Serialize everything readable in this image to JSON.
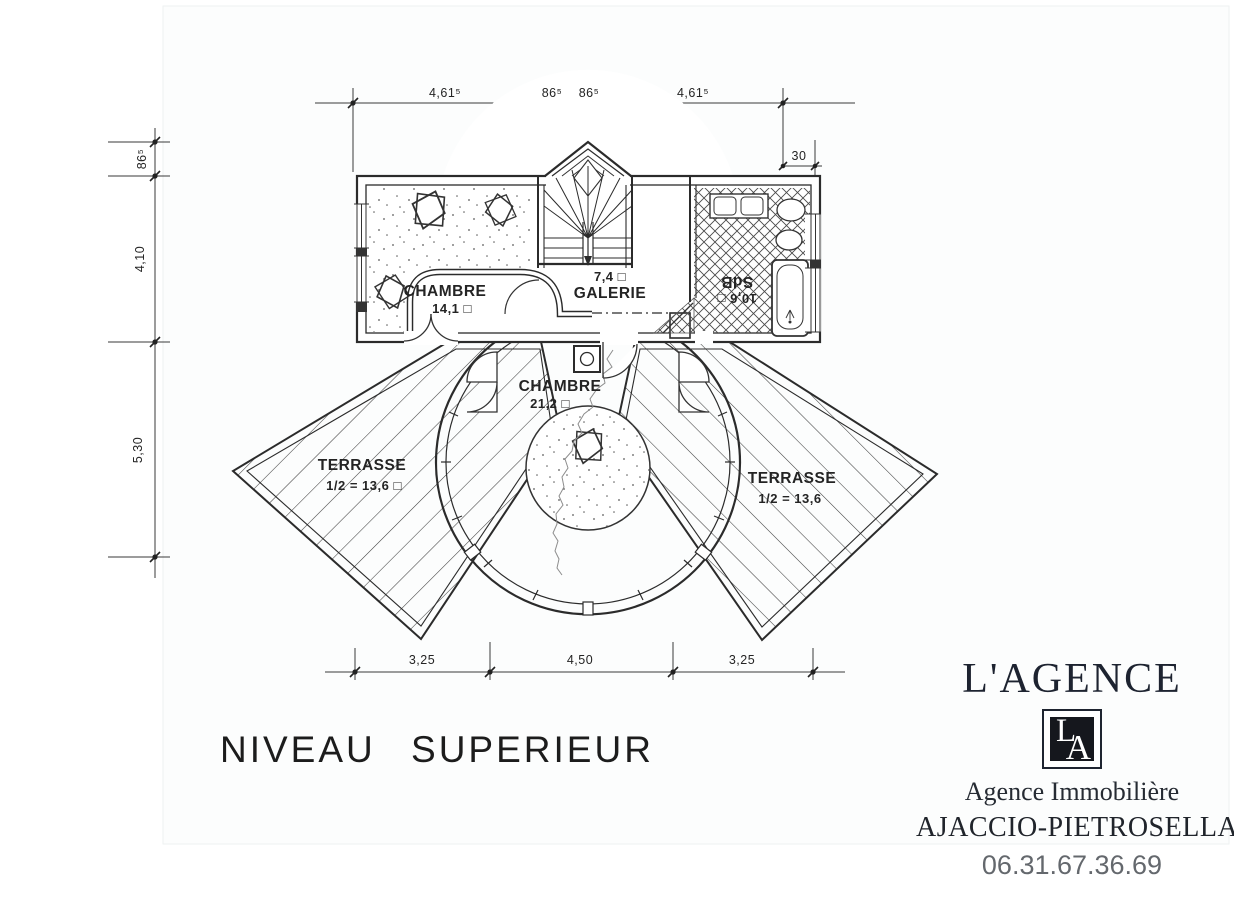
{
  "plan": {
    "title": "NIVEAU SUPERIEUR",
    "rooms": {
      "chambre1": {
        "name": "CHAMBRE",
        "area": "14,1 □"
      },
      "galerie": {
        "name": "GALERIE",
        "area": "7,4 □"
      },
      "sdb": {
        "name": "SdB",
        "area": "10,6 □"
      },
      "chambre2": {
        "name": "CHAMBRE",
        "area": "21,2 □"
      },
      "terrasse_left": {
        "name": "TERRASSE",
        "area": "1/2 = 13,6 □"
      },
      "terrasse_right": {
        "name": "TERRASSE",
        "area": "1/2 = 13,6"
      }
    },
    "dimensions": {
      "top": [
        "4,61⁵",
        "86⁵",
        "86⁵",
        "4,61⁵"
      ],
      "top_offset": "30",
      "left": [
        "86⁵",
        "4,10",
        "5,30"
      ],
      "bottom": [
        "3,25",
        "4,50",
        "3,25"
      ]
    }
  },
  "agency": {
    "name": "L'AGENCE",
    "monogram_l": "L",
    "monogram_a": "A",
    "subtitle": "Agence Immobilière",
    "location": "AJACCIO-PIETROSELLA",
    "phone": "06.31.67.36.69"
  },
  "colors": {
    "ink": "#2b2b2b",
    "brand": "#1d2330",
    "phone_text": "#64686d"
  }
}
